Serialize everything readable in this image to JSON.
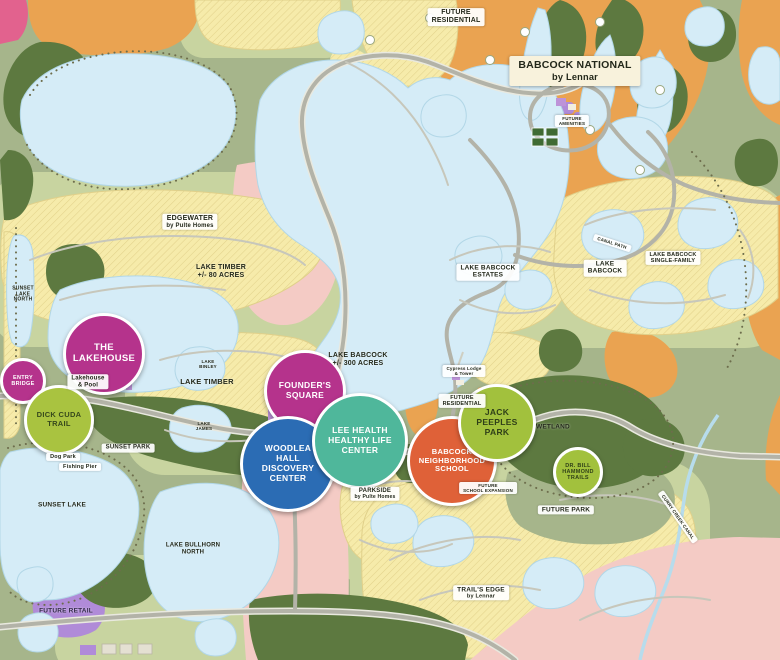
{
  "map": {
    "community_name": "Babcock Ranch master plan map",
    "colors": {
      "terrain_green": "#a6b58b",
      "parcel_light_green": "#c8d4a0",
      "forest_green": "#5d7940",
      "future_development_orange": "#eaa351",
      "mixed_use_pink": "#f4cbc5",
      "future_retail_purple": "#b08bd8",
      "lake_blue": "#d5ecf7",
      "residential_lot_yellow": "#f6ebaa",
      "road_grey": "#b3b3a8",
      "amenity_magenta": "#b5338c",
      "amenity_blue": "#2b6cb4",
      "amenity_teal": "#4fb79b",
      "amenity_orange": "#df6138",
      "amenity_lime": "#a2c13d"
    },
    "badges": [
      {
        "id": "entry-bridge-badge",
        "x": 23,
        "y": 381,
        "r": 20,
        "bg": "#b5338c",
        "fg": "#ffffff",
        "size": 5.5,
        "lines": [
          "ENTRY",
          "BRIDGE"
        ]
      },
      {
        "id": "the-lakehouse-badge",
        "x": 104,
        "y": 354,
        "r": 38,
        "bg": "#b5338c",
        "fg": "#ffffff",
        "size": 9.5,
        "lines": [
          "THE",
          "LAKEHOUSE"
        ]
      },
      {
        "id": "dick-cuda-trail-badge",
        "x": 59,
        "y": 420,
        "r": 32,
        "bg": "#a9c340",
        "fg": "#37491c",
        "size": 7.5,
        "lines": [
          "DICK CUDA",
          "TRAIL"
        ]
      },
      {
        "id": "founders-square-badge",
        "x": 305,
        "y": 391,
        "r": 38,
        "bg": "#b5338c",
        "fg": "#ffffff",
        "size": 8.5,
        "lines": [
          "FOUNDER'S",
          "SQUARE"
        ]
      },
      {
        "id": "woodlea-hall-discovery-center-badge",
        "x": 288,
        "y": 464,
        "r": 45,
        "bg": "#2b6cb4",
        "fg": "#ffffff",
        "size": 8.5,
        "lines": [
          "WOODLEA",
          "HALL",
          "DISCOVERY",
          "CENTER"
        ]
      },
      {
        "id": "lee-health-healthy-life-center-badge",
        "x": 360,
        "y": 441,
        "r": 45,
        "bg": "#4fb79b",
        "fg": "#ffffff",
        "size": 8.5,
        "lines": [
          "LEE HEALTH",
          "HEALTHY LIFE",
          "CENTER"
        ]
      },
      {
        "id": "babcock-neighborhood-school-badge",
        "x": 452,
        "y": 461,
        "r": 42,
        "bg": "#df6138",
        "fg": "#ffffff",
        "size": 7.5,
        "lines": [
          "BABCOCK",
          "NEIGHBORHOOD",
          "SCHOOL"
        ]
      },
      {
        "id": "jack-peeples-park-badge",
        "x": 497,
        "y": 423,
        "r": 36,
        "bg": "#a2c13d",
        "fg": "#2f3f18",
        "size": 8.5,
        "lines": [
          "JACK",
          "PEEPLES",
          "PARK"
        ]
      },
      {
        "id": "dr-bill-hammond-trails-badge",
        "x": 578,
        "y": 472,
        "r": 22,
        "bg": "#a2c13d",
        "fg": "#2f3f18",
        "size": 5.5,
        "lines": [
          "DR. BILL",
          "HAMMOND",
          "TRAILS"
        ]
      }
    ],
    "labels": [
      {
        "id": "future-residential-north-label",
        "x": 456,
        "y": 17,
        "style": "box",
        "size": 7,
        "lines": [
          "FUTURE",
          "RESIDENTIAL"
        ]
      },
      {
        "id": "babcock-national-label",
        "x": 575,
        "y": 71,
        "style": "cream",
        "size": 10.5,
        "lines": [
          "BABCOCK NATIONAL",
          "by Lennar"
        ]
      },
      {
        "id": "future-amenities-label",
        "x": 572,
        "y": 121,
        "style": "box",
        "size": 4.5,
        "lines": [
          "FUTURE",
          "AMENITIES"
        ]
      },
      {
        "id": "edgewater-label",
        "x": 190,
        "y": 222,
        "style": "box",
        "size": 7,
        "sub": true,
        "lines": [
          "EDGEWATER",
          "by Pulte Homes"
        ]
      },
      {
        "id": "lake-timber-acreage-label",
        "x": 221,
        "y": 272,
        "style": "plain",
        "size": 7,
        "lines": [
          "LAKE TIMBER",
          "+/- 80 ACRES"
        ]
      },
      {
        "id": "sunset-lake-north-label",
        "x": 23,
        "y": 295,
        "style": "plain",
        "size": 5,
        "lines": [
          "SUNSET",
          "LAKE",
          "NORTH"
        ]
      },
      {
        "id": "lakehouse-and-pool-label",
        "x": 88,
        "y": 382,
        "style": "box",
        "size": 6,
        "lines": [
          "Lakehouse",
          "& Pool"
        ]
      },
      {
        "id": "lake-babcock-estates-label",
        "x": 488,
        "y": 272,
        "style": "box",
        "size": 6.5,
        "lines": [
          "LAKE BABCOCK",
          "ESTATES"
        ]
      },
      {
        "id": "lake-babcock-neighborhood-label",
        "x": 605,
        "y": 268,
        "style": "box",
        "size": 6.5,
        "lines": [
          "LAKE",
          "BABCOCK"
        ]
      },
      {
        "id": "canal-path-label",
        "x": 612,
        "y": 243,
        "style": "box",
        "size": 4.5,
        "rotate": 18,
        "lines": [
          "CANAL PATH"
        ]
      },
      {
        "id": "lake-babcock-single-family-label",
        "x": 673,
        "y": 258,
        "style": "box",
        "size": 5.5,
        "lines": [
          "LAKE BABCOCK",
          "SINGLE-FAMILY"
        ]
      },
      {
        "id": "lake-babcock-acreage-label",
        "x": 358,
        "y": 360,
        "style": "plain",
        "size": 7,
        "lines": [
          "LAKE BABCOCK",
          "+/- 300 ACRES"
        ]
      },
      {
        "id": "lake-binley-label",
        "x": 208,
        "y": 364,
        "style": "plain",
        "size": 4.5,
        "lines": [
          "LAKE",
          "BINLEY"
        ]
      },
      {
        "id": "lake-timber-label",
        "x": 207,
        "y": 382,
        "style": "plain",
        "size": 7.5,
        "lines": [
          "LAKE TIMBER"
        ]
      },
      {
        "id": "lake-james-label",
        "x": 204,
        "y": 426,
        "style": "plain",
        "size": 4.5,
        "lines": [
          "LAKE",
          "JAMES"
        ]
      },
      {
        "id": "sunset-park-label",
        "x": 128,
        "y": 448,
        "style": "box",
        "size": 6,
        "lines": [
          "SUNSET PARK"
        ]
      },
      {
        "id": "dog-park-label",
        "x": 63,
        "y": 457,
        "style": "box",
        "size": 5.5,
        "lines": [
          "Dog Park"
        ]
      },
      {
        "id": "fishing-pier-label",
        "x": 80,
        "y": 467,
        "style": "box",
        "size": 5.5,
        "lines": [
          "Fishing Pier"
        ]
      },
      {
        "id": "sunset-lake-label",
        "x": 62,
        "y": 505,
        "style": "plain",
        "size": 6.5,
        "lines": [
          "SUNSET LAKE"
        ]
      },
      {
        "id": "future-retail-label",
        "x": 66,
        "y": 611,
        "style": "plain",
        "size": 6.5,
        "color": "#312a47",
        "lines": [
          "FUTURE RETAIL"
        ]
      },
      {
        "id": "lake-bullhorn-north-label",
        "x": 193,
        "y": 549,
        "style": "plain",
        "size": 6,
        "lines": [
          "LAKE BULLHORN",
          "NORTH"
        ]
      },
      {
        "id": "cypress-lodge-tower-label",
        "x": 464,
        "y": 371,
        "style": "box",
        "size": 4.5,
        "lines": [
          "Cypress Lodge",
          "& Tower"
        ]
      },
      {
        "id": "future-residential-mid-label",
        "x": 462,
        "y": 401,
        "style": "box",
        "size": 5.5,
        "lines": [
          "FUTURE",
          "RESIDENTIAL"
        ]
      },
      {
        "id": "future-school-expansion-label",
        "x": 488,
        "y": 488,
        "style": "box",
        "size": 4.5,
        "lines": [
          "FUTURE",
          "SCHOOL EXPANSION"
        ]
      },
      {
        "id": "wetland-label",
        "x": 553,
        "y": 427,
        "style": "plain",
        "size": 6.5,
        "lines": [
          "WETLAND"
        ]
      },
      {
        "id": "future-park-label",
        "x": 566,
        "y": 510,
        "style": "box",
        "size": 6.5,
        "lines": [
          "FUTURE PARK"
        ]
      },
      {
        "id": "trails-edge-label",
        "x": 481,
        "y": 593,
        "style": "box",
        "size": 6.5,
        "sub": true,
        "lines": [
          "TRAIL'S EDGE",
          "by Lennar"
        ]
      },
      {
        "id": "curry-creek-canal-label",
        "x": 678,
        "y": 517,
        "style": "box",
        "size": 4.5,
        "rotate": 55,
        "lines": [
          "CURRY CREEK CANAL"
        ]
      },
      {
        "id": "parkside-label",
        "x": 375,
        "y": 494,
        "style": "box",
        "size": 6,
        "sub": true,
        "lines": [
          "PARKSIDE",
          "by Pulte Homes"
        ]
      }
    ]
  }
}
